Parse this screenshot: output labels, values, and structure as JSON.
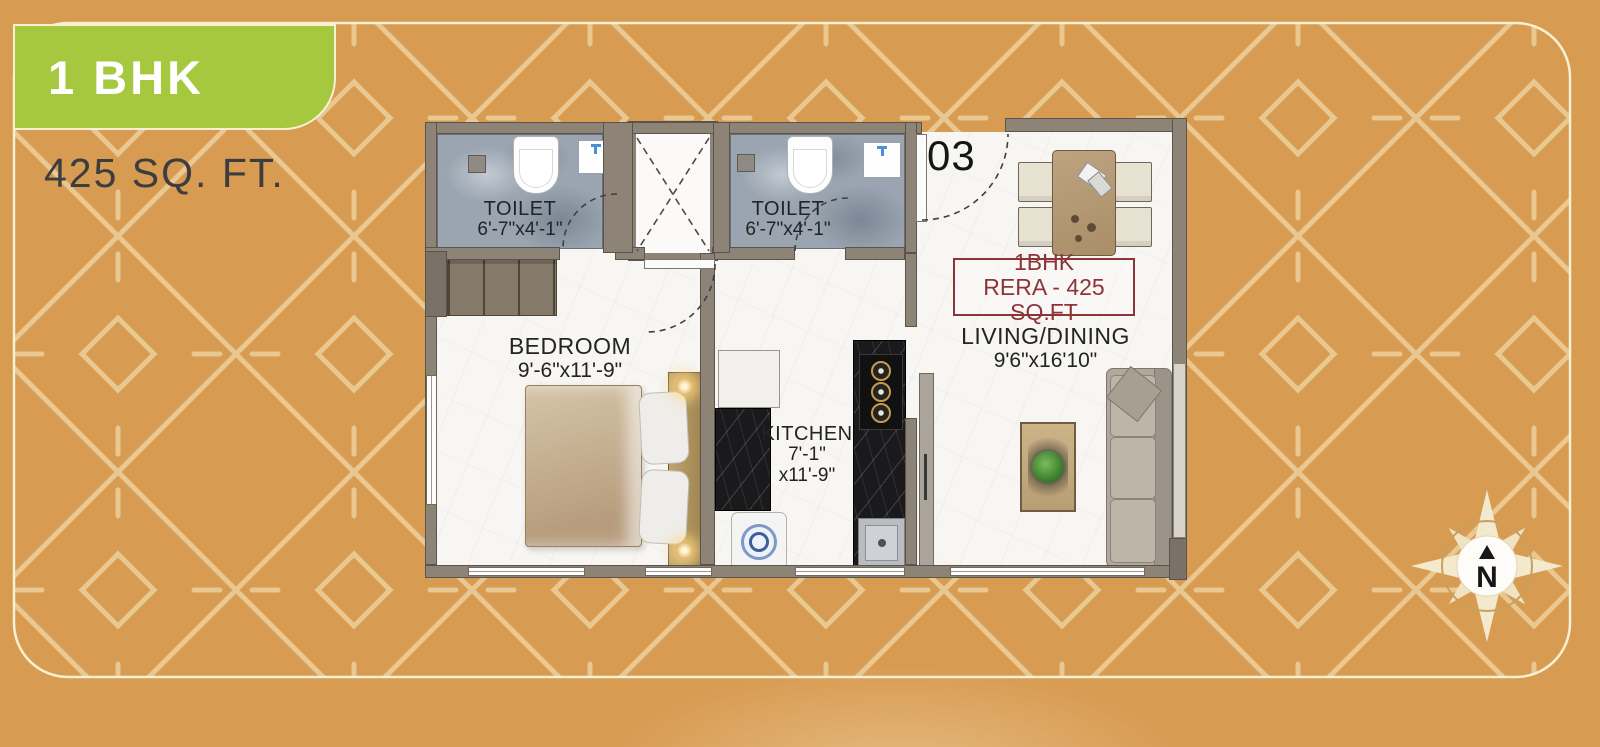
{
  "poster": {
    "badge": {
      "label": "1 BHK"
    },
    "area_text": "425 SQ. FT."
  },
  "plan": {
    "unit_number": "03",
    "rera_box": {
      "line1": "1BHK",
      "line2": "RERA - 425 SQ.FT"
    },
    "rooms": {
      "toilet_1": {
        "name": "TOILET",
        "dims": "6'-7\"x4'-1\""
      },
      "toilet_2": {
        "name": "TOILET",
        "dims": "6'-7\"x4'-1\""
      },
      "bedroom": {
        "name": "BEDROOM",
        "dims": "9'-6\"x11'-9\""
      },
      "kitchen": {
        "name": "KITCHEN",
        "dims_line1": "7'-1\"",
        "dims_line2": "x11'-9\""
      },
      "living_dining": {
        "name": "LIVING/DINING",
        "dims": "9'6\"x16'10\""
      }
    }
  },
  "compass": {
    "north_label": "N"
  },
  "palette": {
    "background_orange": "#d89b52",
    "pattern_cream": "#eed2a0",
    "border_cream": "#f8f0d2",
    "badge_green": "#a5c83e",
    "rera_red": "#8d3438",
    "wall_grey": "#8d8477",
    "toilet_floor_blue": "#9aa5b1",
    "counter_black": "#1a1a1c"
  }
}
